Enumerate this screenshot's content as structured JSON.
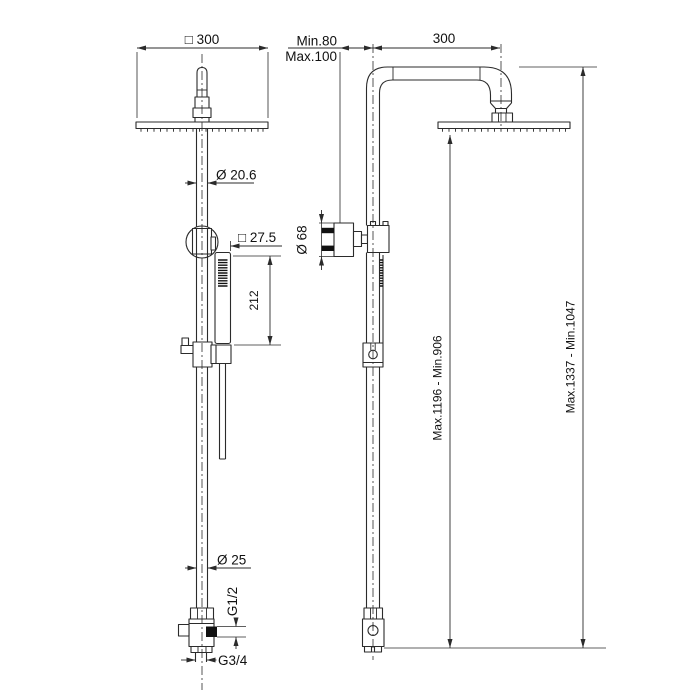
{
  "colors": {
    "background": "#ffffff",
    "line": "#2b2b2b",
    "text": "#111111",
    "dark_fill": "#111111"
  },
  "front_view": {
    "head_width": "□ 300",
    "upper_pipe_diameter": "Ø 20.6",
    "handshower_width": "□ 27.5",
    "handshower_length": "212",
    "lower_pipe_diameter": "Ø 25",
    "side_outlet_thread": "G1/2",
    "bottom_inlet_thread": "G3/4"
  },
  "side_view": {
    "wall_offset_min": "Min.80",
    "wall_offset_max": "Max.100",
    "arm_projection": "300",
    "wall_flange_diameter": "Ø 68",
    "height_to_headshower": "Max.1196 - Min.906",
    "height_overall": "Max.1337 - Min.1047"
  }
}
